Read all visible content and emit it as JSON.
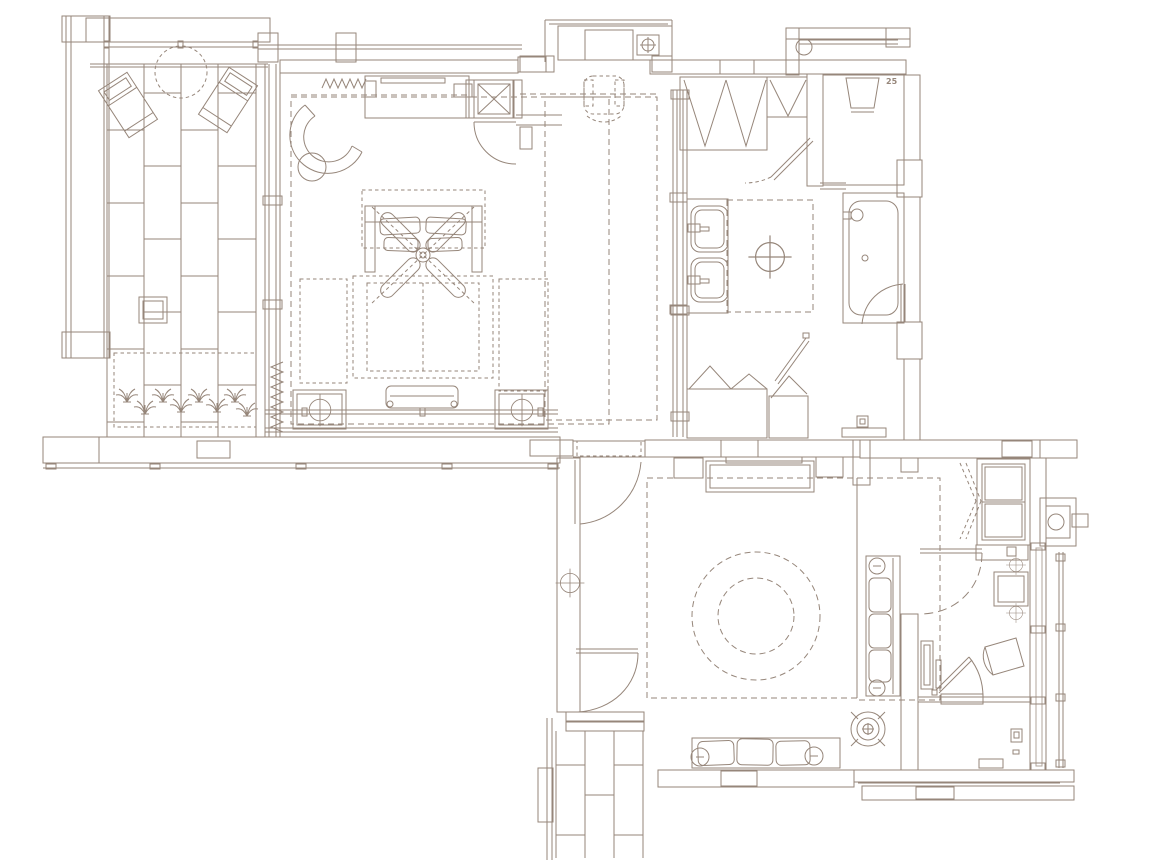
{
  "canvas": {
    "width": 1170,
    "height": 860
  },
  "palette": {
    "paper": "#ffffff",
    "ink": "#96867a",
    "ink_dark": "#83715f",
    "ink_light": "#bfb4a6"
  },
  "annotations": {
    "shower_label": "25"
  },
  "icons": [
    "ceiling-fan-icon",
    "floor-outlet-icon",
    "ceiling-light-icon",
    "spa-target-icon",
    "plant-icon",
    "curtain-zigzag-icon",
    "clothes-hanger-icon",
    "shower-head-icon",
    "equipment-box-icon",
    "toilet-flush-icon",
    "outdoor-shower-icon",
    "insulation-zigzag-icon"
  ]
}
